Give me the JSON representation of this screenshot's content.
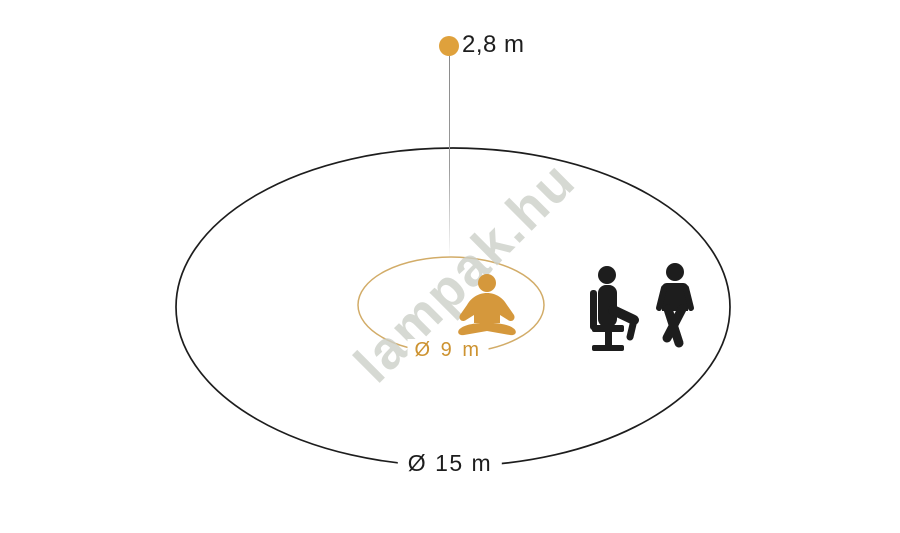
{
  "diagram": {
    "mounting_height": {
      "label": "2,8 m"
    },
    "inner_zone": {
      "label": "Ø 9 m",
      "icon": "meditating-person-icon"
    },
    "outer_zone": {
      "label": "Ø 15 m",
      "icons": [
        "person-on-office-chair-icon",
        "walking-person-icon"
      ]
    },
    "watermark": "lampak.hu",
    "colors": {
      "dot_orange": "#DFA13C",
      "icon_orange": "#D5983C",
      "inner_ellipse_stroke": "#D2AC68",
      "inner_label_orange": "#CD9331",
      "outline_black": "#1D1D1D",
      "drop_line_gray": "#9A9A9A",
      "watermark_gray": "#CCD0C9"
    }
  }
}
